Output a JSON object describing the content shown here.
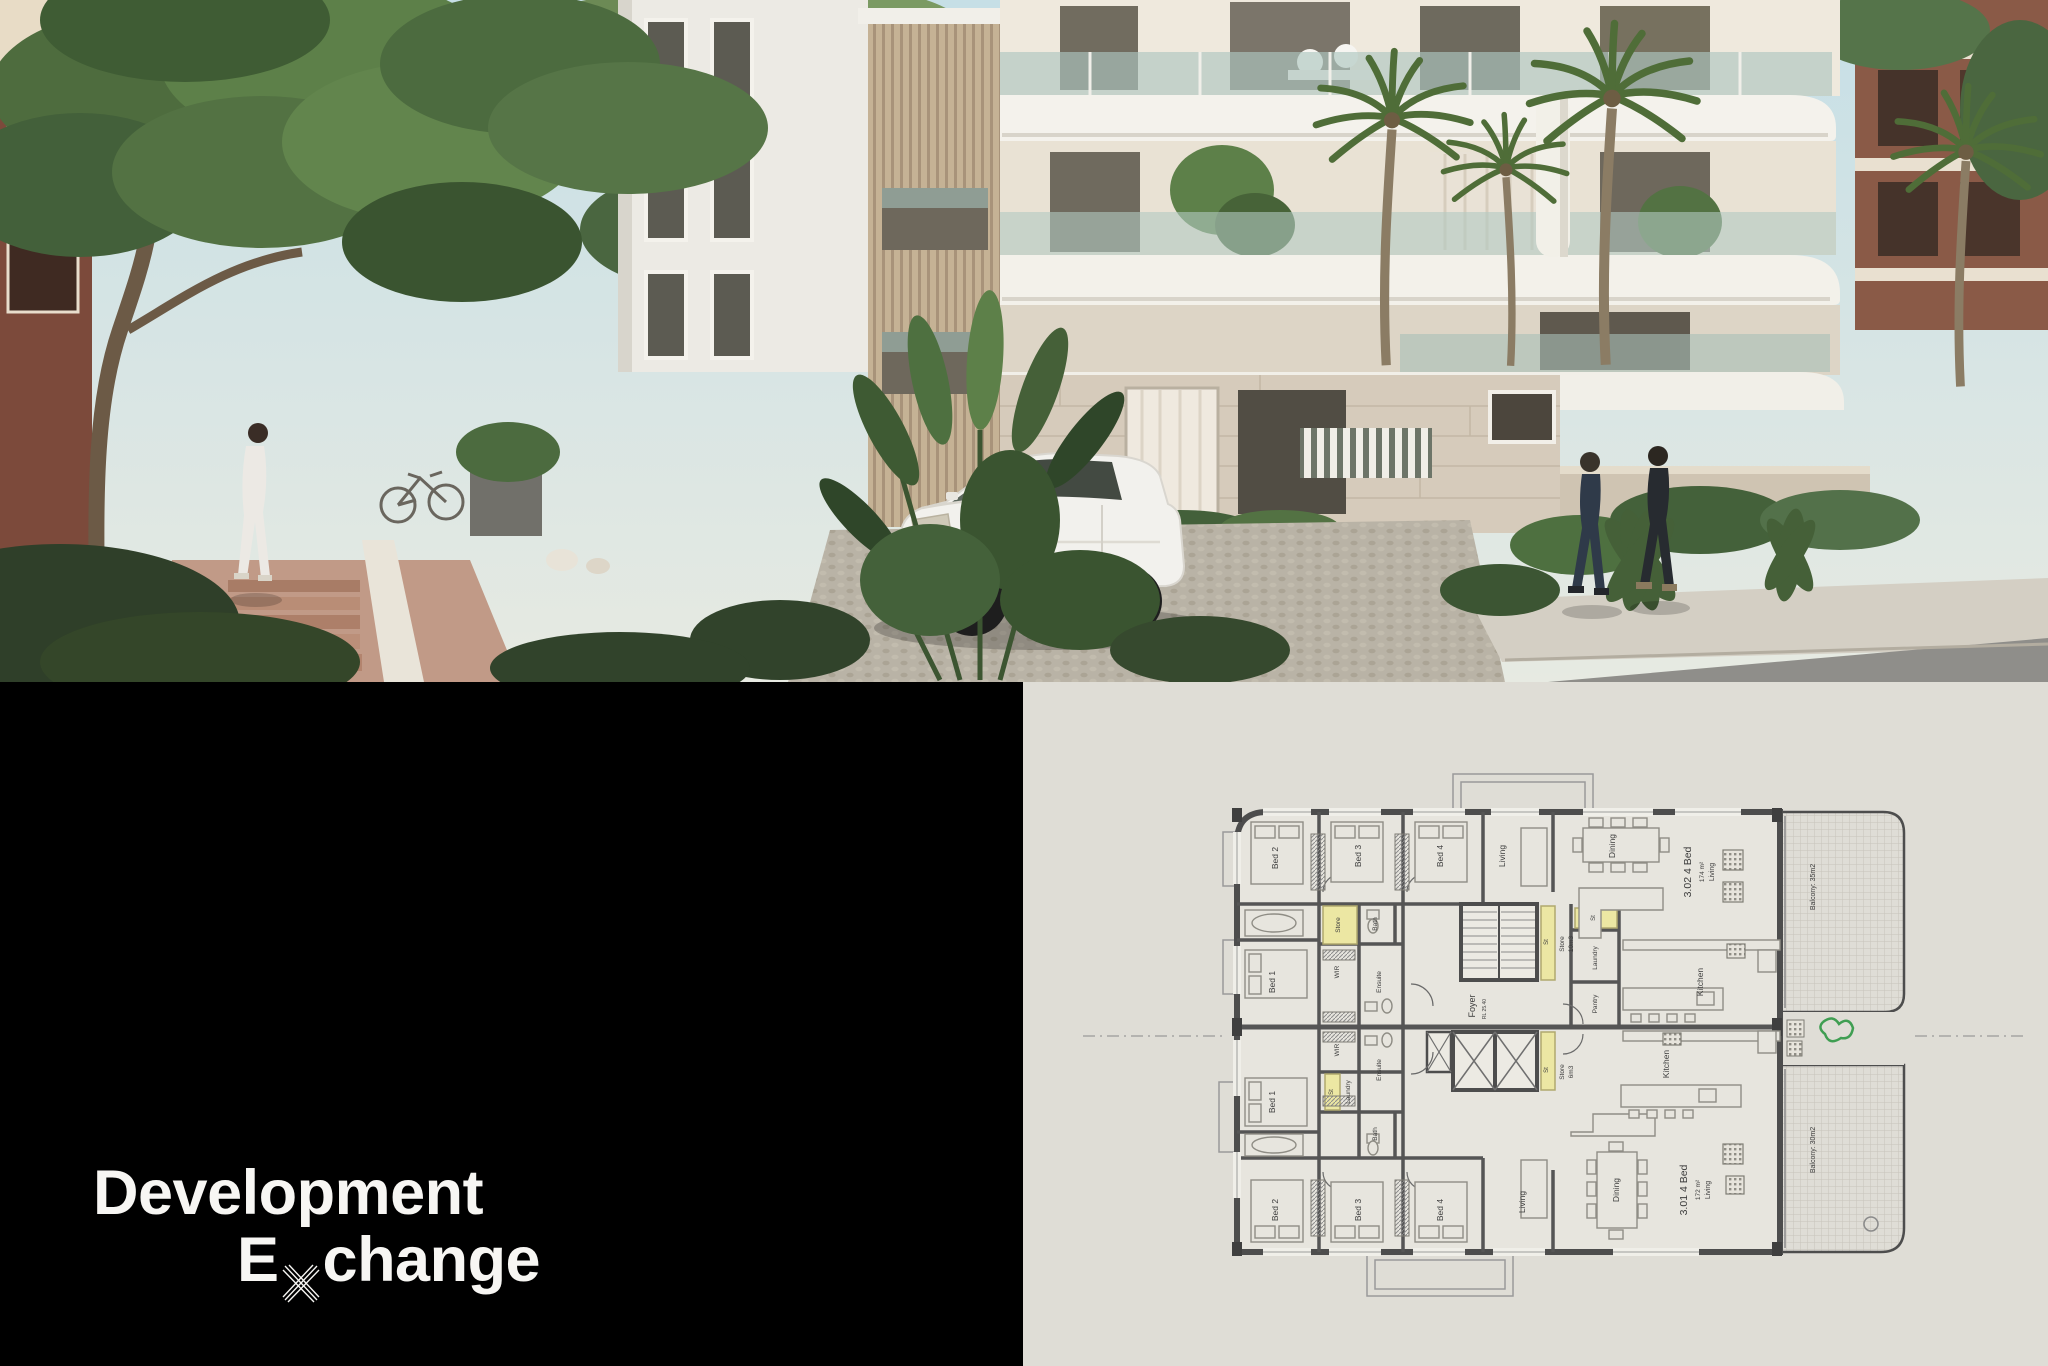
{
  "logo": {
    "line1": "Development",
    "line2_word": "Exchange",
    "line2_pre": "E",
    "line2_post": "change"
  },
  "colors": {
    "brand_panel": "#000000",
    "plan_paper": "#dfddd6",
    "store_highlight": "#ece7a3",
    "wall_grey": "#4d4d4d",
    "plant_green": "#3f9e52"
  },
  "floor_plan": {
    "core": {
      "foyer": "Foyer",
      "level": "RL 25.40"
    },
    "unit_302": {
      "title": "3.02 4 Bed",
      "area": "174 m²",
      "zone": "Living",
      "balcony": "Balcony: 35m2",
      "bed1": "Bed 1",
      "bed2": "Bed 2",
      "bed3": "Bed 3",
      "bed4": "Bed 4",
      "living": "Living",
      "dining": "Dining",
      "kitchen": "Kitchen",
      "pantry": "Pantry",
      "laundry": "Laundry",
      "bath": "Bath",
      "ensuite": "Ensuite",
      "wir": "WIR",
      "store": "Store",
      "st_a": "St",
      "st_b": "St",
      "store_vol_l1": "Store",
      "store_vol_l2": "10m3"
    },
    "unit_301": {
      "title": "3.01 4 Bed",
      "area": "172 m²",
      "zone": "Living",
      "balcony": "Balcony: 30m2",
      "bed1": "Bed 1",
      "bed2": "Bed 2",
      "bed3": "Bed 3",
      "bed4": "Bed 4",
      "living": "Living",
      "dining": "Dining",
      "kitchen": "Kitchen",
      "laundry": "Laundry",
      "bath": "Bath",
      "ensuite": "Ensuite",
      "wir": "WIR",
      "st_a": "St",
      "st_b": "St",
      "store_vol_l1": "Store",
      "store_vol_l2": "6m3"
    }
  }
}
